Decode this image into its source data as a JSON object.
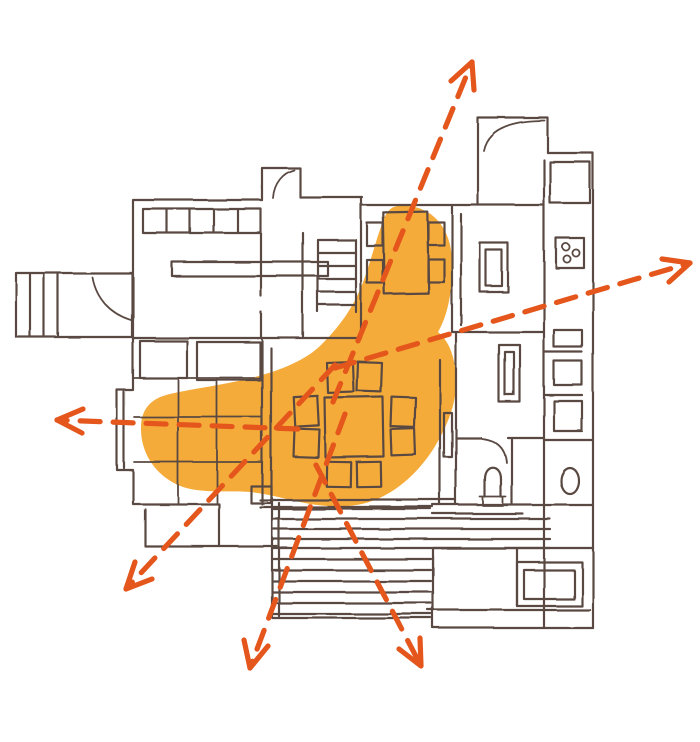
{
  "page": {
    "background": "#ffffff",
    "description": "Hand-drawn architectural floor plan sketch with a highlighted dining-living zone and dashed circulation arrows radiating outward"
  },
  "palette": {
    "plan_line": "#5a4a42",
    "highlight": "#f5ab3a",
    "arrow": "#e4561c"
  },
  "highlight_zone": {
    "name": "activity-highlight-blob",
    "color": "#f5ab3a",
    "covers": [
      "dining-table-area",
      "breakfast-table-area",
      "living-room-left-extension"
    ]
  },
  "arrows": {
    "style": {
      "color": "#e4561c",
      "stroke_width": 5.2,
      "dash": "20 13"
    },
    "items": [
      {
        "name": "arrow-up",
        "direction": "up",
        "x1": 333,
        "y1": 402,
        "x2": 472,
        "y2": 62,
        "head": [
          [
            451,
            81
          ],
          [
            472,
            62
          ],
          [
            474,
            90
          ]
        ]
      },
      {
        "name": "arrow-right",
        "direction": "right",
        "x1": 335,
        "y1": 368,
        "x2": 690,
        "y2": 263,
        "head": [
          [
            662,
            259
          ],
          [
            690,
            263
          ],
          [
            669,
            282
          ]
        ]
      },
      {
        "name": "arrow-left",
        "direction": "left",
        "x1": 298,
        "y1": 429,
        "x2": 57,
        "y2": 420,
        "head": [
          [
            82,
            433
          ],
          [
            57,
            420
          ],
          [
            83,
            409
          ]
        ]
      },
      {
        "name": "arrow-down-left",
        "direction": "down-left",
        "x1": 335,
        "y1": 365,
        "x2": 126,
        "y2": 589,
        "head": [
          [
            152,
            579
          ],
          [
            126,
            589
          ],
          [
            135,
            562
          ]
        ]
      },
      {
        "name": "arrow-down",
        "direction": "down",
        "x1": 345,
        "y1": 414,
        "x2": 250,
        "y2": 668,
        "head": [
          [
            268,
            646
          ],
          [
            250,
            668
          ],
          [
            244,
            640
          ]
        ]
      },
      {
        "name": "arrow-down-right",
        "direction": "down-right",
        "x1": 316,
        "y1": 465,
        "x2": 421,
        "y2": 666,
        "head": [
          [
            420,
            638
          ],
          [
            421,
            666
          ],
          [
            399,
            649
          ]
        ]
      }
    ]
  },
  "furniture": {
    "dining_table_chairs": 8,
    "breakfast_table_chairs": 4,
    "stove_burners": 3,
    "porch_steps": 3,
    "stair_treads": 5,
    "deck_planks": 11
  },
  "rooms": [
    "porch",
    "top-left-room",
    "hallway",
    "stair-hall",
    "breakfast-nook",
    "entry",
    "galley-kitchen",
    "living-room",
    "dining-area",
    "bathroom",
    "utility-room",
    "terrace-deck"
  ]
}
